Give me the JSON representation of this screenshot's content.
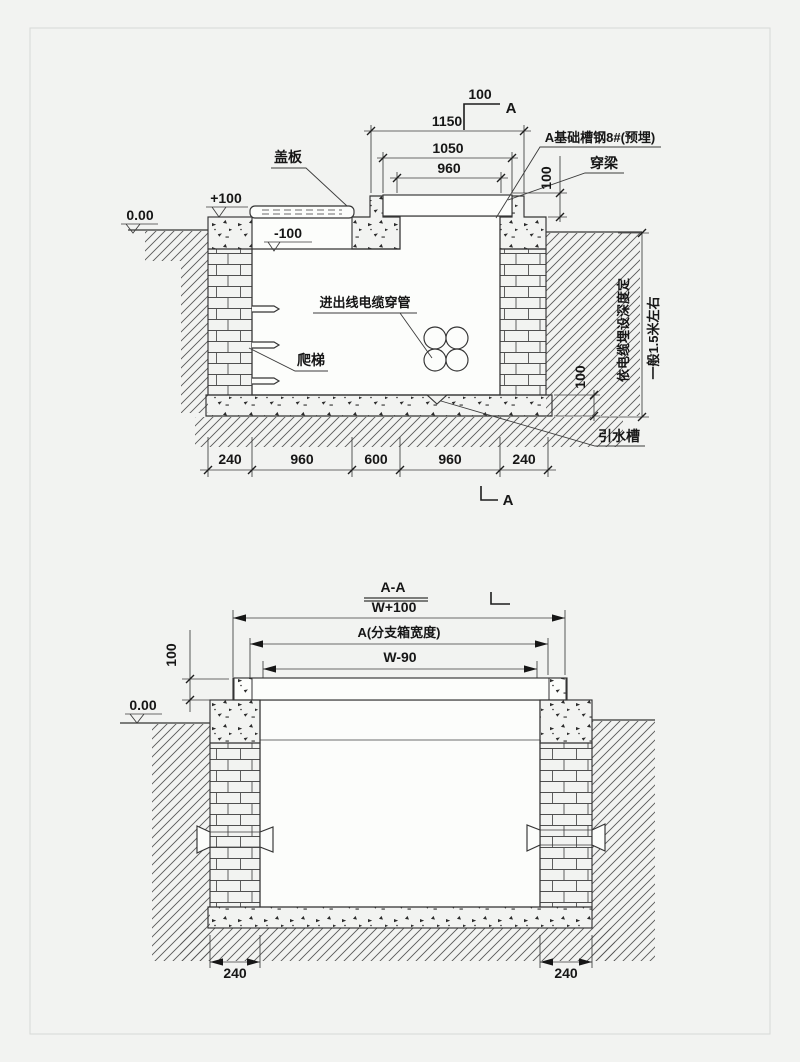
{
  "bg": "#f2f3f1",
  "ink": "#343434",
  "top_view": {
    "section_cut_top": {
      "offset": "100",
      "label": "A"
    },
    "dim_1150": "1150",
    "dim_1050": "1050",
    "dim_960": "960",
    "elev_zero": "0.00",
    "elev_plus": "+100",
    "elev_minus": "-100",
    "label_cover": "盖板",
    "label_channel_steel": "A基础槽钢8#(预埋)",
    "label_beam": "穿梁",
    "dim_beam_offset": "100",
    "label_conduit": "进出线电缆穿管",
    "label_ladder": "爬梯",
    "label_drain": "引水槽",
    "dim_chain": [
      "240",
      "960",
      "600",
      "960",
      "240"
    ],
    "depth_note_line1": "依电缆埋设深度定",
    "depth_note_line2": "一般1.5米左右",
    "dim_slab_thickness": "100",
    "section_mark_bottom": "A"
  },
  "bottom_view": {
    "title": "A-A",
    "dim_width_plus": "W+100",
    "dim_box_width": "A(分支箱宽度)",
    "dim_width_minus": "W-90",
    "dim_slab_thickness": "100",
    "elev_zero": "0.00",
    "dim_240_left": "240",
    "dim_240_right": "240"
  }
}
